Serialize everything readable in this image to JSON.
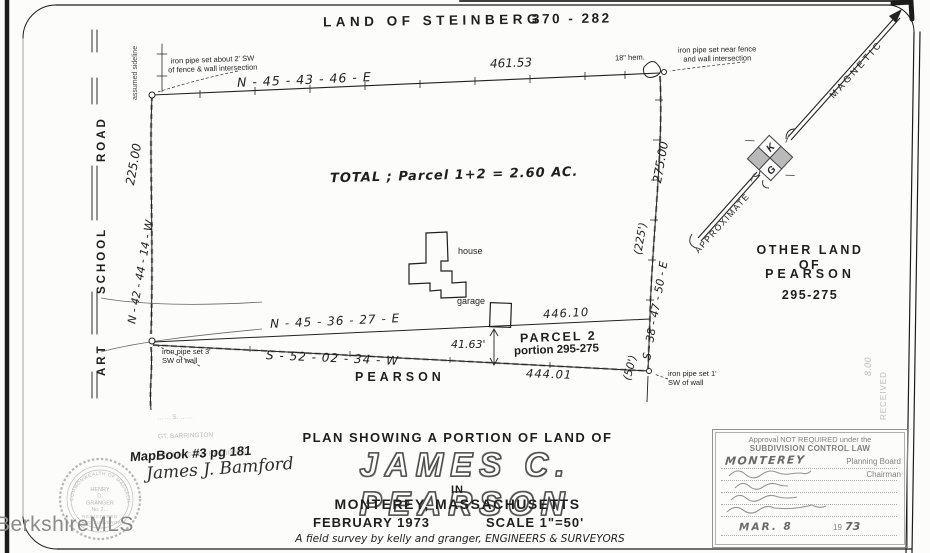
{
  "header": {
    "land_of": "LAND OF STEINBERG",
    "deed_ref": "370 - 282"
  },
  "north_arrow": {
    "magnetic": "MAGNETIC",
    "approximate": "APPROXIMATE",
    "k": "K",
    "g": "G"
  },
  "road": {
    "art": "ART",
    "school": "SCHOOL",
    "road": "ROAD",
    "assumed_sideline": "assumed sideline"
  },
  "survey": {
    "north_bearing": "N - 45 - 43 - 46 - E",
    "north_distance": "461.53",
    "west_bearing": "N - 42 - 44 - 14 - W",
    "west_distance": "225.00",
    "east_bearing": "S - 38 - 47 - 50 - E",
    "east_distance": "275.00",
    "east_tie_upper": "(225')",
    "east_tie_lower": "(50')",
    "p2_north_bearing": "N - 45 - 36 - 27 - E",
    "p2_north_distance": "446.10",
    "p2_south_bearing": "S - 52 - 02 - 34 - W",
    "p2_south_distance": "444.01",
    "garage_offset": "41.63'",
    "total": "TOTAL ;  Parcel 1+2 = 2.60 AC.",
    "hemlock": "18\" hem.",
    "pipe_nw": "iron pipe set about 2' SW\nof fence & wall intersection",
    "pipe_ne": "iron pipe set near fence\nand wall intersection",
    "pipe_sw": "iron pipe set 3'\nSW of wall",
    "pipe_se": "iron pipe set 1'\nSW of wall",
    "house": "house",
    "garage": "garage",
    "parcel2": "PARCEL 2",
    "parcel2_portion": "portion 295-275",
    "abutter_south": "PEARSON",
    "other_land": {
      "l1": "OTHER LAND OF",
      "l2": "PEARSON",
      "l3": "295-275"
    }
  },
  "title_block": {
    "plan_line": "PLAN SHOWING A PORTION OF LAND OF",
    "owner": "JAMES C. PEARSON",
    "in": "IN",
    "town": "MONTEREY, MASSACHUSETTS",
    "date": "FEBRUARY 1973",
    "scale": "SCALE  1\"=50'",
    "credit": "A field survey by kelly and granger, ENGINEERS & SURVEYORS"
  },
  "annotations": {
    "mapbook": "MapBook #3 pg 181",
    "signature": "James J. Bamford",
    "fee": "8.00",
    "received": "RECEIVED"
  },
  "recorder_stamp": {
    "l1": "……  S. ……",
    "l2": "GT. BARRINGTON",
    "l3": "RECEIVED AND RECORDED"
  },
  "seal": {
    "ring_top": "COMMONWEALTH OF MASSACHUSETTS",
    "n1": "HENRY",
    "n2": "D.",
    "n3": "GRANGER",
    "n4": "No. 2…",
    "reg": "REGISTERED",
    "surv": "LAND SURVEYOR"
  },
  "approval": {
    "l1": "Approval NOT REQUIRED under the",
    "l2": "SUBDIVISION CONTROL LAW",
    "town": "MONTEREY",
    "board": "Planning Board",
    "chairman": "Chairman",
    "date": "MAR. 8",
    "year_prefix": "19",
    "year": "73"
  },
  "watermark": "BerkshireMLS"
}
